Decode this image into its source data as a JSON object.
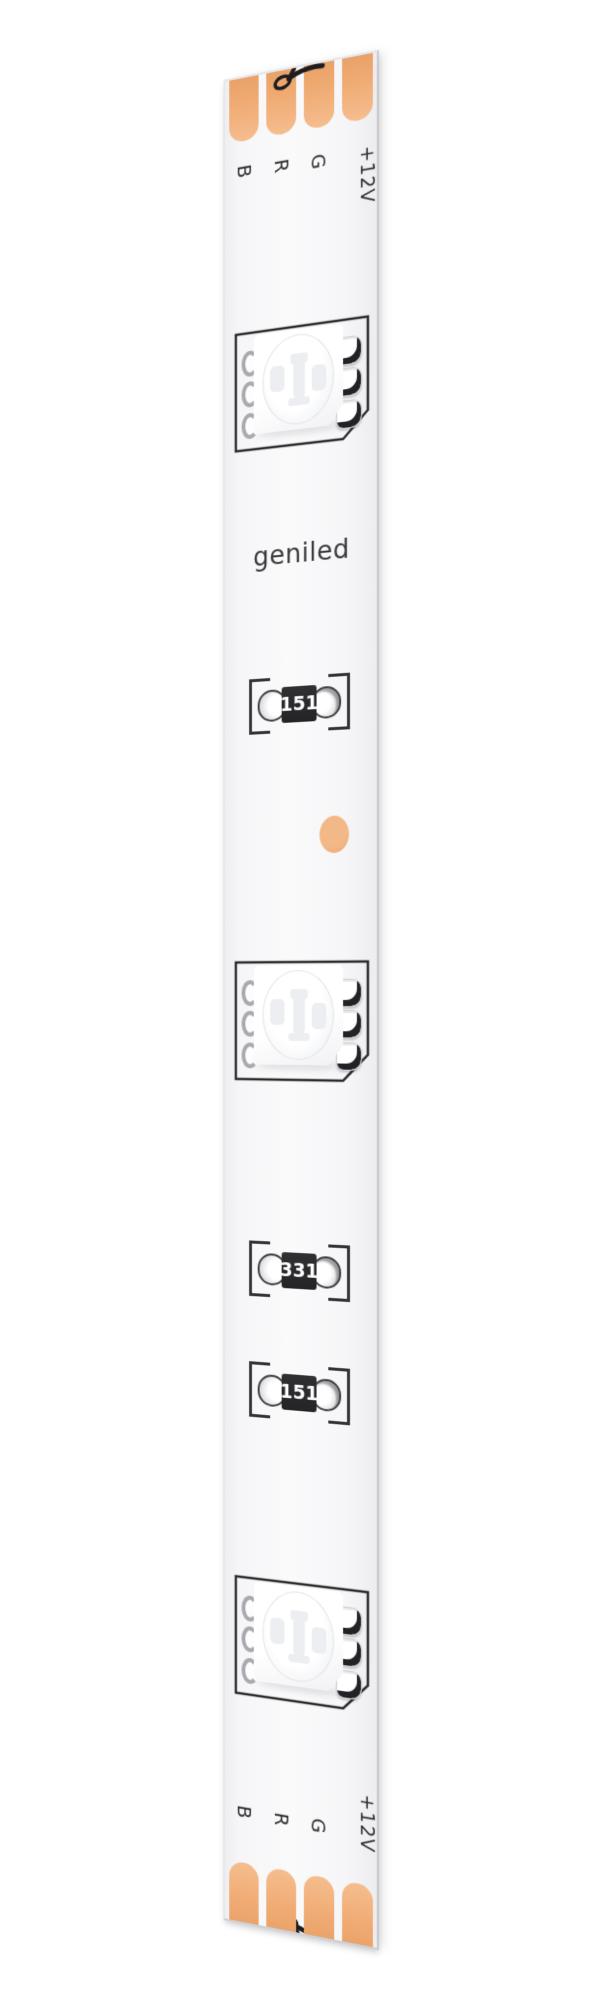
{
  "page": {
    "background": "#ffffff"
  },
  "strip": {
    "brand": "geniled",
    "colors": {
      "pcb": "#f7f7f9",
      "copper_pad": "#f0ab74",
      "component_outline": "#2c2c2e",
      "resistor_body": "#28282a",
      "resistor_text": "#ffffff",
      "logo_text": "#3a3a3c",
      "label_text": "#2f2f31"
    },
    "top": {
      "labels": [
        "B",
        "R",
        "G",
        "+12V"
      ],
      "pad_count": 4,
      "icon": "scissors-cut-line"
    },
    "bottom": {
      "labels": [
        "B",
        "R",
        "G",
        "+12V"
      ],
      "pad_count": 4,
      "icon": "scissors-cut-line"
    },
    "components": {
      "led_count": 3,
      "resistors": [
        {
          "code": "151"
        },
        {
          "code": "331"
        },
        {
          "code": "151"
        }
      ]
    }
  }
}
